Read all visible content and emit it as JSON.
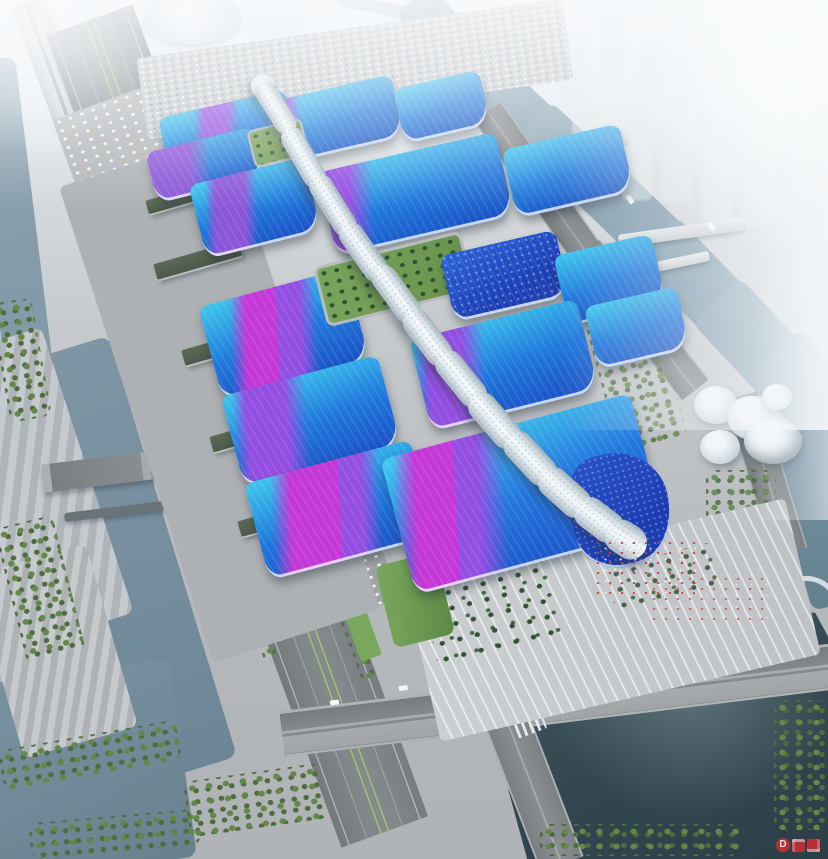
{
  "scene": {
    "type": "aerial architectural rendering",
    "subject": "large riverside exhibition and convention center complex",
    "view": "bird's-eye oblique view in hazy daylight",
    "features": [
      "two columns of wave-roofed exhibition halls with blue gradient roofs crossed by purple and magenta ribbon stripes",
      "white serpentine pedestrian spine running the full length of the complex",
      "grand south entrance hall with dotted dark-blue wedge and white swoosh canopy",
      "green roof garden strip between the central halls",
      "stepped entrance plaza with palm trees and crowds of tiny figures",
      "surface parking lots with rows of cars and trucks on the north and west",
      "multi-lane boulevard with green medians and an elevated viaduct along the west edge",
      "river with terraced embankments on the west and a winding river with bridges on the east",
      "organic white cultural buildings beside the east river",
      "dark pond and a road intersection with crosswalks at the south-east",
      "hazy white city skyline with a domed building to the north"
    ]
  },
  "palette": {
    "haze": "#eef2f5",
    "haze2": "#dde4e9",
    "ground": "#b6b9bc",
    "ground2": "#c7cacc",
    "apron": "#aeb1b4",
    "road": "#7b8083",
    "road2": "#8e9295",
    "roadline": "#e9ecee",
    "median": "#a3c46c",
    "waterL": "#7e95a4",
    "waterL2": "#6d8697",
    "pond": "#435863",
    "pond2": "#2c3f49",
    "riverR": "#8fa8b6",
    "cyan": "#3cc3ec",
    "blue": "#1f78dd",
    "deep": "#1b52c4",
    "indigo": "#2440ae",
    "purple": "#8a55d8",
    "magenta": "#c438d8",
    "violet": "#934ee2",
    "spine": "#edf2f5",
    "spineshade": "#aab8c2",
    "tree": "#4d6d3e",
    "tree2": "#628849",
    "lawn": "#79a85c",
    "palm": "#2f5231",
    "white": "#f2f5f7",
    "eave": "#e3eaee",
    "shadow": "#2c3640",
    "red": "#d22b2f"
  },
  "watermark": {
    "text": "D",
    "color": "#d22b2f"
  }
}
